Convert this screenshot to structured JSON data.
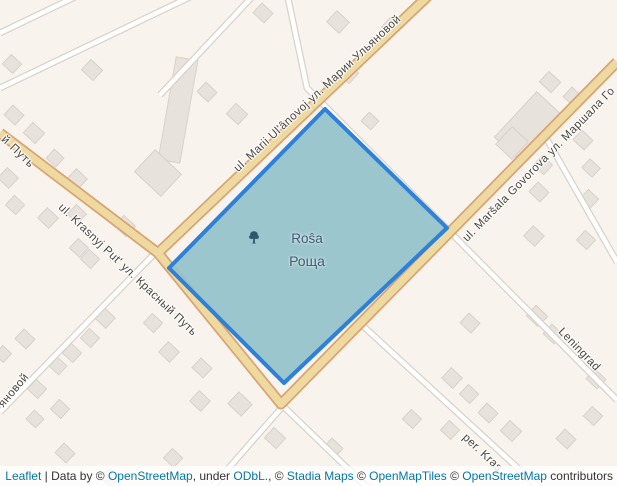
{
  "map": {
    "park": {
      "name_latin": "Roŝa",
      "name_cyrillic": "Роща",
      "icon": "tree-icon"
    },
    "street_labels": {
      "ulyanovoj": "ul. Marii Ulʹânovoj ул. Марии Ульяновой",
      "krasnyj_put": "ul. Krasnyj Putʹ ул. Красный Путь",
      "krasnyj_put_fragment": "й Путь",
      "govorova": "ul. Maršala Govorova ул. Маршала Го",
      "leningrad": "Leningrad",
      "per_kras": "per. Kras",
      "ulyanovoj_fragment": "яновой"
    }
  },
  "attribution": {
    "segments": [
      {
        "text": "Leaflet",
        "link": true
      },
      {
        "text": " | Data by © ",
        "link": false
      },
      {
        "text": "OpenStreetMap",
        "link": true
      },
      {
        "text": ", under ",
        "link": false
      },
      {
        "text": "ODbL.",
        "link": true
      },
      {
        "text": ", © ",
        "link": false
      },
      {
        "text": "Stadia Maps",
        "link": true
      },
      {
        "text": " © ",
        "link": false
      },
      {
        "text": "OpenMapTiles",
        "link": true
      },
      {
        "text": " © ",
        "link": false
      },
      {
        "text": "OpenStreetMap",
        "link": true
      },
      {
        "text": " contributors",
        "link": false
      }
    ]
  },
  "colors": {
    "background": "#f8f3ec",
    "building": "#e8e2dc",
    "building_stroke": "#d9d2ca",
    "road_major_fill": "#eed9a0",
    "road_major_casing": "#d9a474",
    "road_minor_fill": "#ffffff",
    "road_minor_casing": "#d8d2ca",
    "park_fill": "#93c2ca",
    "park_stroke": "#2e80d8",
    "label": "#4a4640",
    "park_label": "#3e5a74",
    "link": "#0078a8"
  }
}
